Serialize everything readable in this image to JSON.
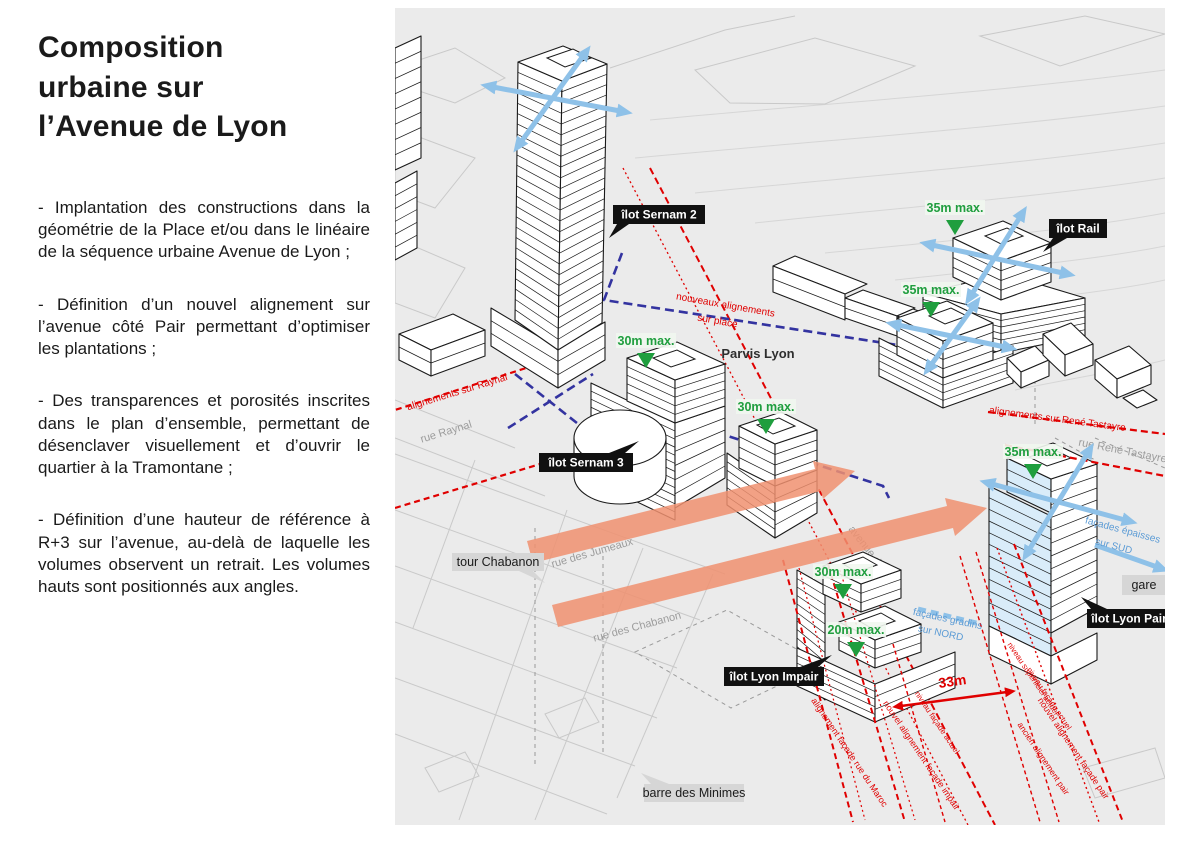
{
  "title": "Composition\nurbaine sur\nl’Avenue de Lyon",
  "paragraphs": [
    "- Implantation des constructions dans la géométrie de la Place et/ou dans le linéaire de la séquence urbaine Avenue de Lyon ;",
    "- Définition d’un nouvel alignement sur l’avenue côté Pair permettant d’optimiser les plantations ;",
    "- Des transparences et porosités inscrites dans le plan d’ensemble, permettant de désenclaver visuellement et d’ouvrir le quartier à la Tramontane ;",
    "- Définition d’une hauteur de référence à R+3 sur l’avenue, au-delà de laquelle les volumes observent un retrait. Les volumes hauts sont positionnés aux angles."
  ],
  "diagram": {
    "ilots": {
      "sernam2": "îlot Sernam 2",
      "rail": "îlot Rail",
      "sernam3": "îlot Sernam 3",
      "lyon_impair": "îlot Lyon Impair",
      "lyon_pair": "îlot Lyon Pair"
    },
    "places": {
      "tour_chabanon": "tour Chabanon",
      "barre_minimes": "barre des Minimes",
      "gare": "gare",
      "parvis": "Parvis Lyon"
    },
    "streets": {
      "raynal": "rue Raynal",
      "jumeaux": "rue des Jumeaux",
      "chabanon": "rue des Chabanon",
      "avenue_lyon": "avenue de Lyon",
      "tastayre": "rue René Tastayre"
    },
    "heights": {
      "h35": "35m max.",
      "h30": "30m max.",
      "h20": "20m max."
    },
    "alignments": {
      "raynal": "alignements sur Raynal",
      "place_line1": "nouveaux alignements",
      "place_line2": "sur place",
      "tastayre": "alignements sur René Tastayre",
      "maroc": "alignement façade rue du Maroc",
      "impair": "nouvel alignement façade impair",
      "pair": "nouvel alignement façade pair",
      "ancien": "ancien alignement pair",
      "niveau_facade": "niveau façade actuel",
      "niveau_superficiel": "niveau superficiel actuel"
    },
    "facades": {
      "sud_line1": "façades épaisses",
      "sud_line2": "sur SUD",
      "nord_line1": "façades gradins",
      "nord_line2": "sur NORD"
    },
    "dimension_33": "33m",
    "colors": {
      "red": "#e00000",
      "dark_blue": "#3333a0",
      "light_blue": "#8ec1e8",
      "orange": "#f09070",
      "green": "#1f9e3e",
      "label_black": "#111111",
      "label_gray": "#d6d6d6",
      "ground": "#ebebeb"
    }
  }
}
